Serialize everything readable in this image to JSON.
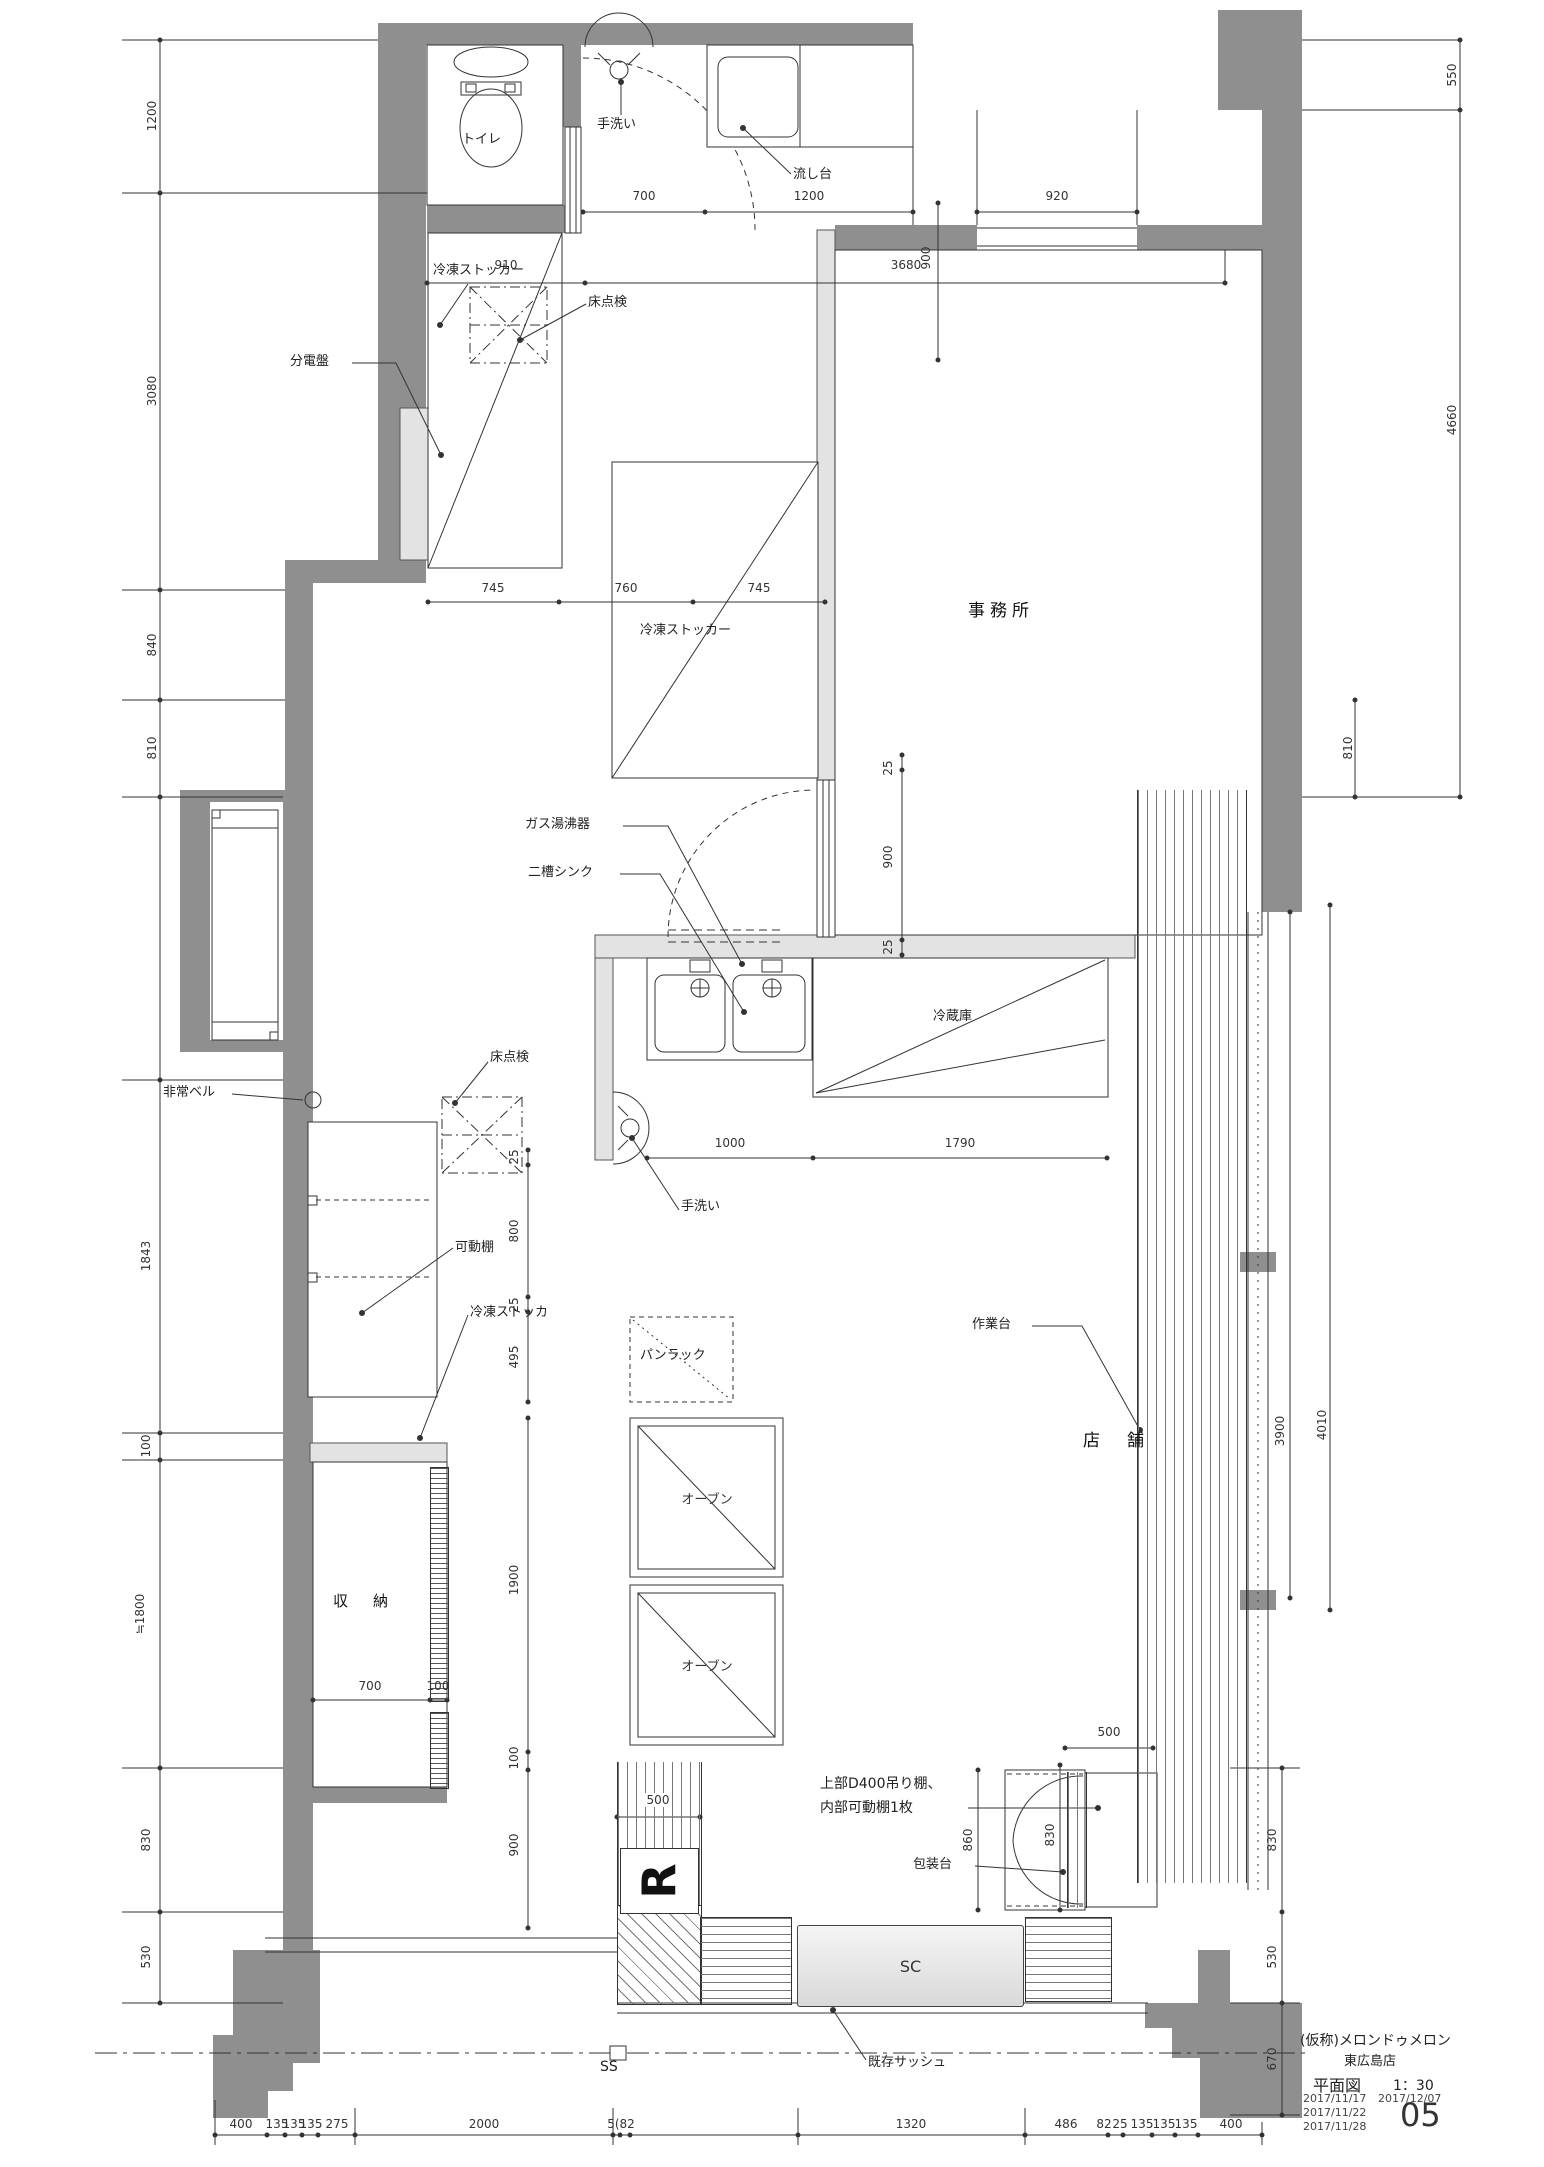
{
  "title_block": {
    "project": "(仮称)メロンドゥメロン",
    "store": "東広島店",
    "drawing_name": "平面図",
    "scale": "1：30",
    "dates": [
      "2017/11/17",
      "2017/11/22",
      "2017/11/28"
    ],
    "date_latest": "2017/12/07",
    "sheet_no": "05"
  },
  "rooms": {
    "toilet": "トイレ",
    "office": "事務所",
    "shop": "店　舗",
    "storage": "収　納"
  },
  "labels": {
    "hand_wash_top": "手洗い",
    "sink_unit": "流し台",
    "dist_board": "分電盤",
    "floor_hatch1": "床点検",
    "freezer1": "冷凍ストッカー",
    "freezer2": "冷凍ストッカー",
    "gas_heater": "ガス湯沸器",
    "double_sink": "二槽シンク",
    "fridge": "冷蔵庫",
    "hand_wash2": "手洗い",
    "emergency_bell": "非常ベル",
    "floor_hatch2": "床点検",
    "movable_shelf": "可動棚",
    "freezer3": "冷凍ストッカ",
    "bread_rack": "パンラック",
    "oven1": "オーブン",
    "oven2": "オーブン",
    "work_table": "作業台",
    "shelf_note_line1": "上部D400吊り棚、",
    "shelf_note_line2": "内部可動棚1枚",
    "packing_table": "包装台",
    "sc_unit": "SC",
    "ss_mark": "SS",
    "existing_sash": "既存サッシュ",
    "r_mark": "R"
  },
  "dims": {
    "top": {
      "d700": "700",
      "d1200": "1200",
      "d920": "920",
      "d910": "910",
      "d3680": "3680",
      "d900": "900",
      "d550": "550"
    },
    "left": [
      "1200",
      "3080",
      "840",
      "810",
      "1843",
      "100",
      "≒1800",
      "830",
      "530"
    ],
    "right": {
      "d4660": "4660",
      "d810": "810",
      "d3900": "3900",
      "d4010": "4010",
      "d830": "830",
      "d530": "530",
      "d670": "670"
    },
    "mid": {
      "d745a": "745",
      "d760": "760",
      "d745b": "745",
      "d25a": "25",
      "d900door": "900",
      "d25b": "25",
      "d1000": "1000",
      "d1790": "1790",
      "d25c": "25",
      "d800": "800",
      "d25d": "25",
      "d495": "495",
      "d1900": "1900",
      "d100a": "100",
      "d900b": "900",
      "d700s": "700",
      "d100s": "100",
      "d500r": "500",
      "d500p": "500",
      "d860": "860",
      "d830p": "830"
    },
    "bottom": [
      "400",
      "135",
      "135",
      "135",
      "275",
      "2000",
      "5(82",
      "1320",
      "486",
      "82",
      "25",
      "135",
      "135",
      "135",
      "400"
    ]
  }
}
